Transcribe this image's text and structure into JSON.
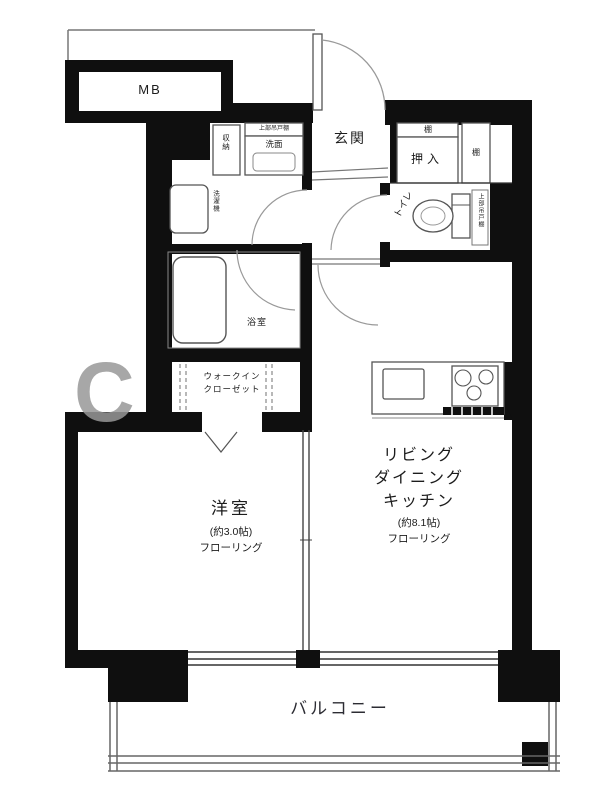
{
  "plan": {
    "mb": "MB",
    "entrance": "玄関",
    "closet": {
      "label": "押入",
      "shelf_top": "棚",
      "shelf_right": "棚"
    },
    "toilet": {
      "label": "トイレ",
      "cabinet": "上部吊戸棚"
    },
    "washroom": {
      "vanity": "洗面",
      "vanity_cabinet": "上部吊戸棚",
      "storage": "収納",
      "washer": "洗濯機"
    },
    "bath": {
      "label": "浴室"
    },
    "wic": {
      "line1": "ウォークイン",
      "line2": "クローゼット"
    },
    "western_room": {
      "label": "洋室",
      "size": "(約3.0帖)",
      "floor": "フローリング"
    },
    "ldk": {
      "line1": "リビング",
      "line2": "ダイニング",
      "line3": "キッチン",
      "size": "(約8.1帖)",
      "floor": "フローリング"
    },
    "balcony": "バルコニー",
    "watermark": "C",
    "colors": {
      "wall": "#0f0f0f",
      "line": "#555555",
      "watermark": "#989898"
    }
  }
}
